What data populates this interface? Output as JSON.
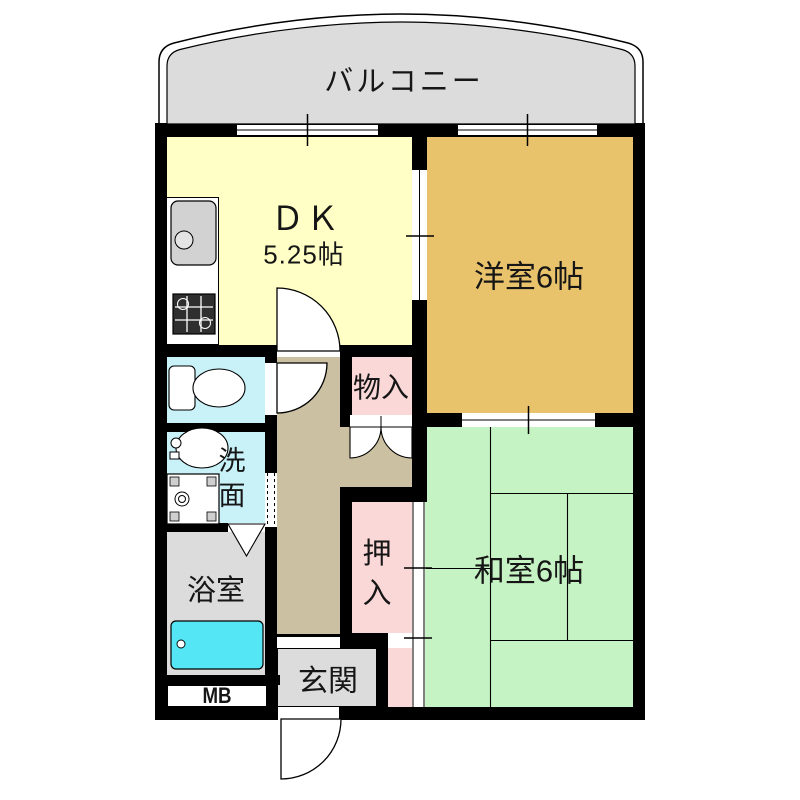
{
  "floorplan": {
    "balcony_label": "バルコニー",
    "dk_label": "ＤＫ",
    "dk_size": "5.25帖",
    "western_room_label": "洋室6帖",
    "japanese_room_label": "和室6帖",
    "storage_label": "物入",
    "closet_label": "押入",
    "washroom_label": "洗面",
    "bathroom_label": "浴室",
    "entrance_label": "玄関",
    "meter_box_label": "MB"
  },
  "colors": {
    "wall": "#000000",
    "dk": "#FFFFC6",
    "western_room": "#E9C36C",
    "japanese_room": "#C6F3C4",
    "storage_closet": "#FBD8D8",
    "hallway": "#CBC1A2",
    "toilet_washroom": "#C8F1F8",
    "bathtub": "#54E6F5",
    "gray_area": "#DCDCDC",
    "balcony": "#DCDCDC",
    "kitchen_sink": "#D2D2D2",
    "stove": "#2F2F2F"
  }
}
